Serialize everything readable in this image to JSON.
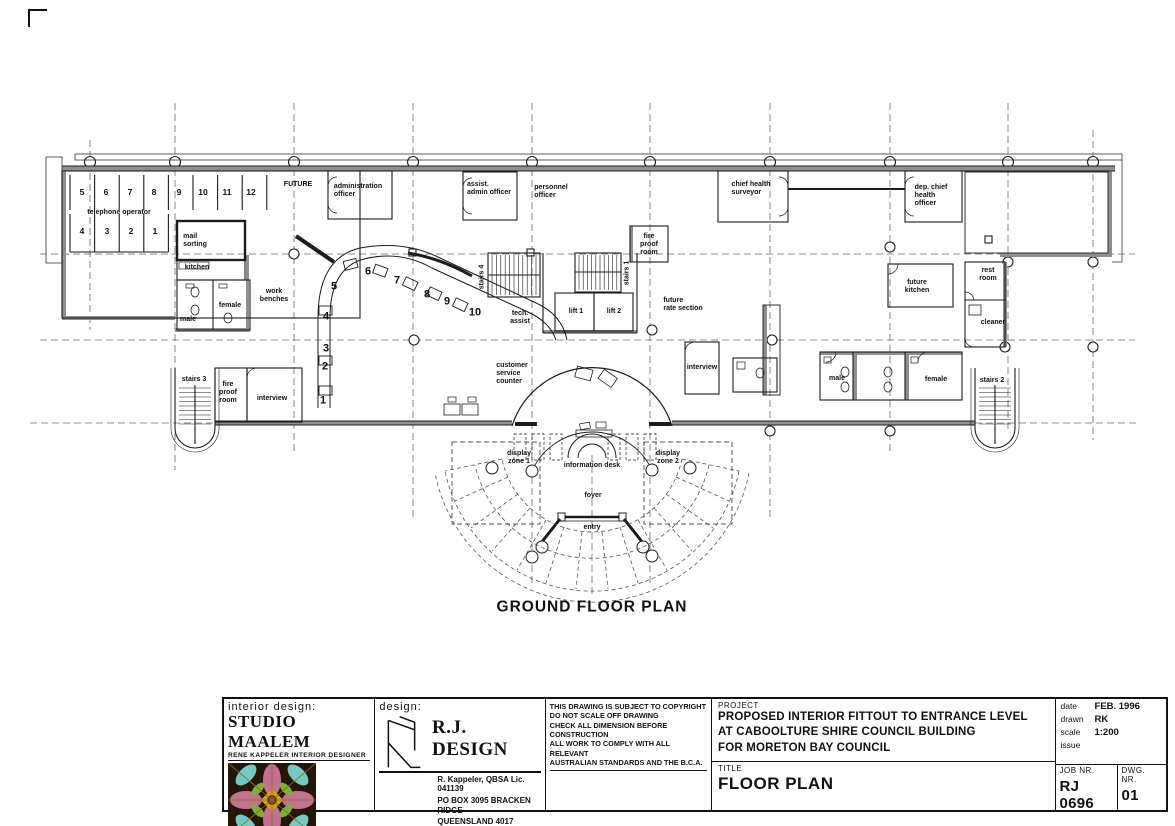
{
  "plan": {
    "caption": "GROUND FLOOR PLAN",
    "booths_top": [
      "5",
      "6",
      "7",
      "8",
      "9",
      "10",
      "11",
      "12"
    ],
    "booths_bottom": [
      "4",
      "3",
      "2",
      "1"
    ],
    "counter_positions": [
      "1",
      "2",
      "3",
      "4",
      "5",
      "6",
      "7",
      "8",
      "9",
      "10"
    ],
    "labels": {
      "telephone_operator": "telephone  operator",
      "future": "FUTURE",
      "administration_officer": "administration\nofficer",
      "assist_admin_officer": "assist.\nadmin  officer",
      "personnel_officer": "personnel\nofficer",
      "chief_health_surveyor": "chief  health\nsurveyor",
      "dep_chief_health_officer": "dep.  chief\nhealth\nofficer",
      "mail_sorting": "mail\nsorting",
      "kitchen": "kitchen",
      "work_benches": "work\nbenches",
      "male_left": "male",
      "female_left": "female",
      "fire_proof_center": "fire\nproof\nroom",
      "stairs_4": "stairs 4",
      "stairs_1": "stairs 1",
      "lift_1": "lift 1",
      "lift_2": "lift 2",
      "tech_assist": "tech.\nassist",
      "future_rate_section": "future\nrate section",
      "interview_center": "interview",
      "customer_service_counter": "customer\nservice\ncounter",
      "display_zone_1": "display\nzone 1",
      "information_desk": "information desk",
      "display_zone_2": "display\nzone 2",
      "foyer": "foyer",
      "entry": "entry",
      "future_kitchen": "future\nkitchen",
      "rest_room": "rest\nroom",
      "cleaner": "cleaner",
      "male_right": "male",
      "female_right": "female",
      "stairs_2": "stairs 2",
      "stairs_3": "stairs 3",
      "fire_proof_left": "fire\nproof\nroom",
      "interview_left": "interview"
    }
  },
  "title_block": {
    "interior_design": {
      "heading": "interior design:",
      "studio": "STUDIO MAALEM",
      "subtitle": "RENE KAPPELER INTERIOR DESIGNER"
    },
    "design": {
      "heading": "design:",
      "firm": "R.J. DESIGN",
      "credential": "R. Kappeler, QBSA Lic. 041139",
      "address_line1": "PO BOX 3095 BRACKEN RIDGE",
      "address_line2": "QUEENSLAND 4017",
      "phone": "PHONE 0412 645 323   FAX (07) 3261 2286",
      "email": "E-mail  renek@rjdesign.com.au"
    },
    "notes": [
      "THIS DRAWING IS SUBJECT TO COPYRIGHT",
      "DO NOT SCALE OFF DRAWING",
      "CHECK ALL DIMENSION BEFORE CONSTRUCTION",
      "ALL WORK TO COMPLY WITH ALL RELEVANT",
      "AUSTRALIAN STANDARDS AND THE B.C.A."
    ],
    "project": {
      "label": "PROJECT",
      "line1": "PROPOSED INTERIOR FITTOUT TO ENTRANCE LEVEL",
      "line2": "AT CABOOLTURE SHIRE COUNCIL BUILDING",
      "line3": "FOR MORETON BAY COUNCIL"
    },
    "title": {
      "label": "TITLE",
      "value": "FLOOR PLAN"
    },
    "meta": {
      "date_label": "date",
      "date": "FEB. 1996",
      "drawn_label": "drawn",
      "drawn": "RK",
      "scale_label": "scale",
      "scale": "1:200",
      "issue_label": "issue",
      "job_label": "JOB NR.",
      "job": "RJ 0696",
      "dwg_label": "DWG. NR.",
      "dwg": "01"
    }
  }
}
